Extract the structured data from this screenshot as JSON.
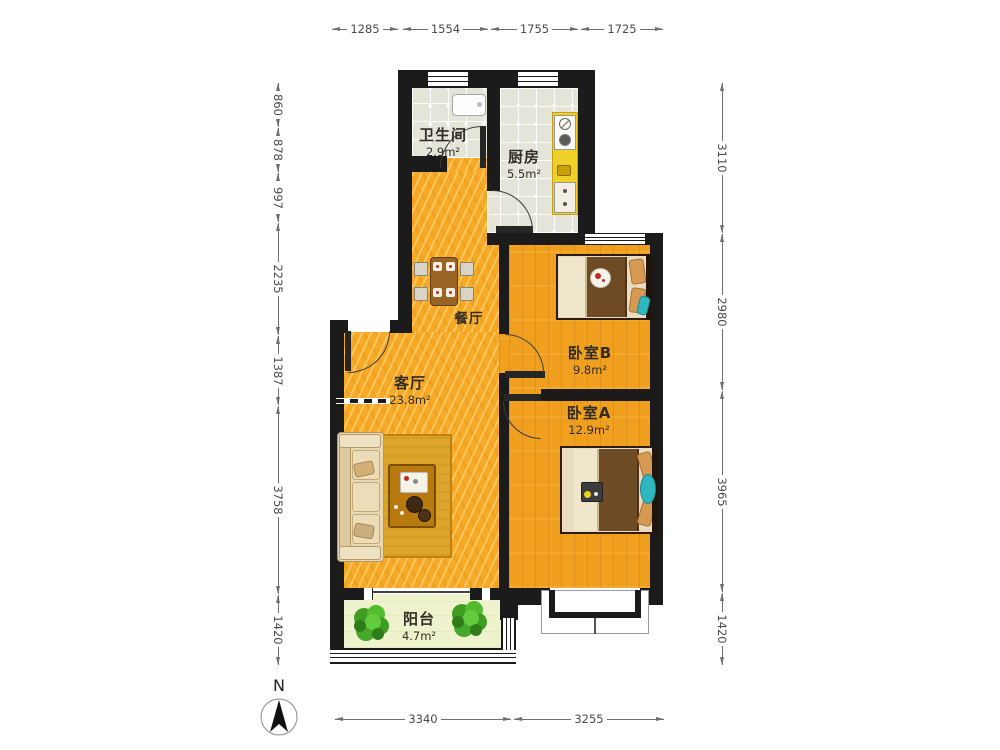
{
  "rooms": {
    "bathroom": {
      "name": "卫生间",
      "area": "2.9m²"
    },
    "kitchen": {
      "name": "厨房",
      "area": "5.5m²"
    },
    "dining": {
      "name": "餐厅"
    },
    "bedroom_b": {
      "name": "卧室B",
      "area": "9.8m²"
    },
    "living": {
      "name": "客厅",
      "area": "23.8m²"
    },
    "bedroom_a": {
      "name": "卧室A",
      "area": "12.9m²"
    },
    "balcony": {
      "name": "阳台",
      "area": "4.7m²"
    }
  },
  "dimensions": {
    "top": [
      "1285",
      "1554",
      "1755",
      "1725"
    ],
    "left": [
      "860",
      "878",
      "997",
      "2235",
      "1387",
      "3758",
      "1420"
    ],
    "right": [
      "3110",
      "2980",
      "3965",
      "1420"
    ],
    "bottom": [
      "3340",
      "3255"
    ]
  },
  "compass": {
    "label": "N"
  },
  "colors": {
    "wall": "#1b1b1b",
    "floor_living": "#f7a928",
    "floor_bedroom": "#f0a01e",
    "floor_tile": "#e5e4d9",
    "floor_balcony": "#eef3cd",
    "kitchen_counter": "#eed028",
    "bed_blanket": "#6e4b24",
    "sofa": "#e9d8b4",
    "rug": "#dda42c",
    "accent_teal": "#2fb6be",
    "plant_green": "#46a82a",
    "dimension_text": "#4a4a4a"
  }
}
